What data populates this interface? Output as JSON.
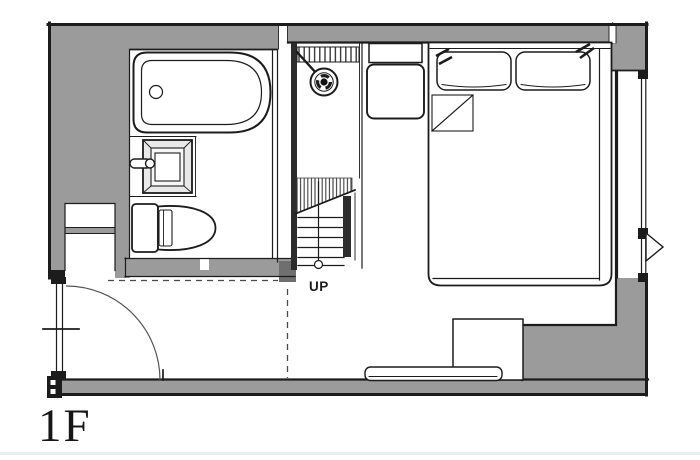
{
  "floor_plan": {
    "floor_label": "1F",
    "stairs_label": "UP",
    "depicted_rooms": [
      "bathroom",
      "shower-stair-strip",
      "bedroom",
      "entry"
    ],
    "depicted_fixtures": [
      "bathtub",
      "vanity-sink",
      "toilet",
      "shower-head",
      "staircase-up",
      "double-bed",
      "pillows",
      "folded-blanket",
      "nightstand",
      "entry-door-swing",
      "left-window",
      "right-window",
      "casement-flag",
      "platform-step",
      "low-shelf"
    ]
  },
  "colors": {
    "wall": "#9b9b9b",
    "line": "#1c1c1c",
    "paper": "#ffffff",
    "faint": "#e9eded"
  }
}
